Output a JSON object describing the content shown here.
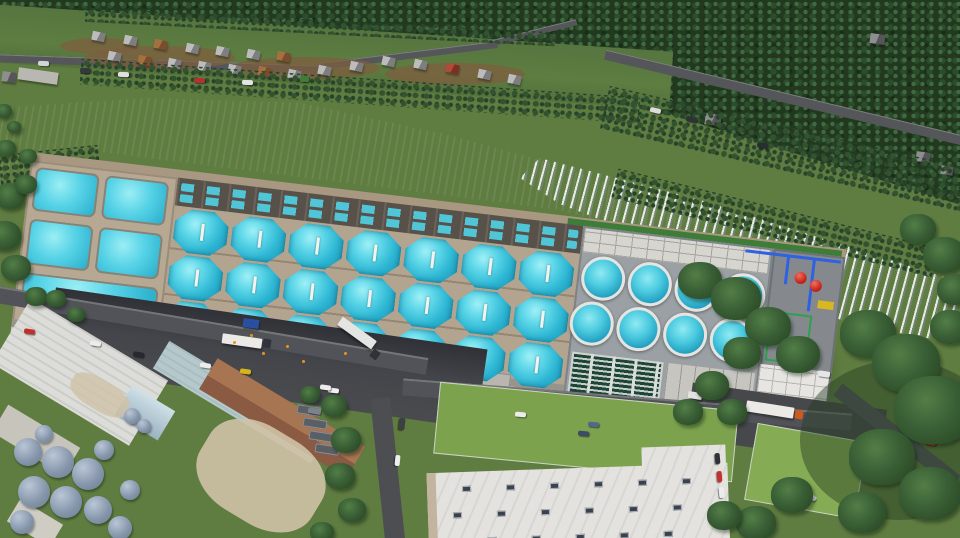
{
  "scene": {
    "type": "aerial-3d-architectural-rendering",
    "description": "Aerial rendering of a large land-based fish-farming facility with open-top turquoise tanks, set beside a forest river with rapids, a cabin village, roads and industrial buildings",
    "time_of_day": "daylight"
  },
  "facility": {
    "logo_text": "hima",
    "logo_color": "#E8941A",
    "octagonal_tanks": {
      "rows": 3,
      "per_row": 7
    },
    "circular_tanks": {
      "rows": 2,
      "per_row": 4
    },
    "left_section_pools": 5,
    "raceway_strips": 2,
    "red_process_tanks": 2,
    "filter_banks": 1
  },
  "palette": {
    "forest": "#23391f",
    "grass": "#5f7c41",
    "river_dark": "#2e3742",
    "river_rapids": "#c7ced4",
    "tank_water": "#3fc4da",
    "facility_walls": "#b7a894",
    "facade_white": "#dfdcd5",
    "accent_orange": "#E8941A",
    "asphalt": "#45474b",
    "tech_blue": "#2f62e0",
    "tech_red": "#c8281c",
    "tech_green": "#2da14e",
    "filter_green": "#1d4636"
  },
  "environment": {
    "cabins": 21,
    "houses": 6,
    "vehicles": 31,
    "trucks": 5,
    "silos": 13,
    "tree_clusters": 38,
    "skylight_grid": {
      "rows": 3,
      "cols": 6
    }
  }
}
